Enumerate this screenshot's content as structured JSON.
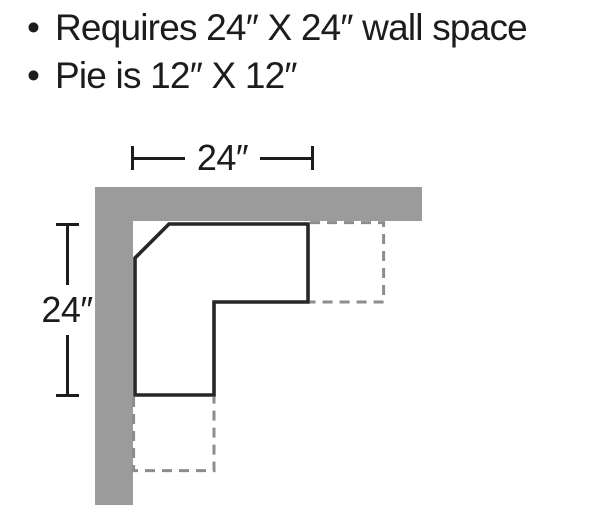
{
  "page": {
    "background": "#ffffff"
  },
  "bullets": [
    {
      "marker": "•",
      "text": "Requires 24″ X 24″ wall space"
    },
    {
      "marker": "•",
      "text": "Pie is 12″ X 12″"
    }
  ],
  "diagram": {
    "type": "corner-pie-cabinet-wall-space-plan",
    "top_dimension": {
      "label": "24″"
    },
    "left_dimension": {
      "label": "24″"
    },
    "colors": {
      "wall": "#9b9b9b",
      "cabinet_outline": "#272727",
      "dashed_extension": "#8d8d8d",
      "text": "#1c1c1c"
    }
  }
}
